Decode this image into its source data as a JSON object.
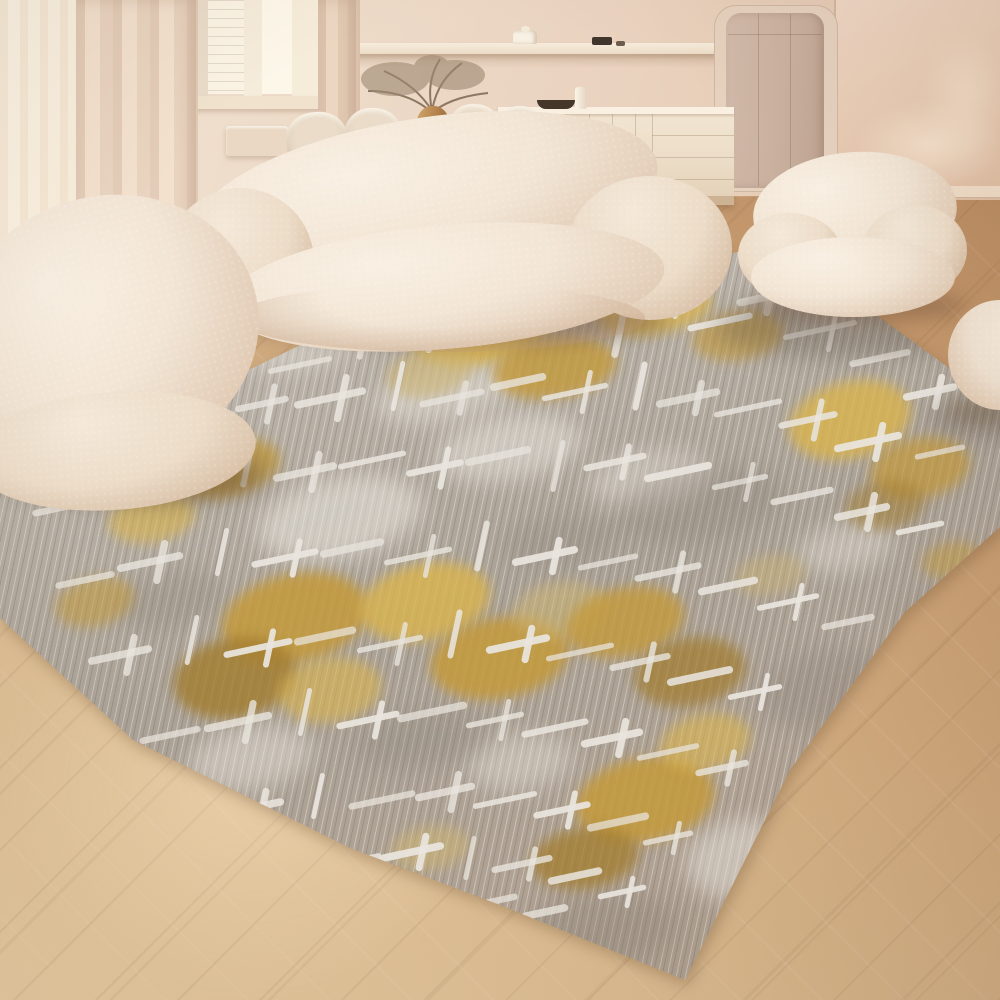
{
  "scene": {
    "label": "living-room-rug-product-photo",
    "objects": [
      "area-rug",
      "curved-boucle-sofa",
      "boucle-lounge-chair",
      "boucle-pouf",
      "boucle-ball-seat",
      "cream-sideboard",
      "wall-shelf",
      "dining-table",
      "dining-chairs",
      "amber-vase-dried-branches",
      "window",
      "sheer-curtains",
      "taupe-door-panel",
      "herringbone-wood-floor",
      "radiator",
      "dark-bowl",
      "white-cylinder-vase",
      "lidded-jar",
      "small-dark-objects"
    ]
  },
  "palette": {
    "wall": "#ecd9c8",
    "wallRight": "#e8cdb8",
    "window": "#fdf4e4",
    "curtain": "#e9d3c0",
    "cream": "#f3e7d9",
    "creamShade": "#d9c0a7",
    "sideboard": "#f0e3d0",
    "door": "#ccb4a3",
    "floorLight": "#e6c89e",
    "floorDark": "#b3845a",
    "rugBase": "#b6afa5",
    "rugLight": "#d8d4cc",
    "rugDark": "#978f84",
    "rugWhite": "#eae6df",
    "gold1": "#dab44e",
    "gold2": "#c49a3a",
    "bronze": "#a37d2e",
    "paleGold": "#cdb472",
    "bowlDark": "#443729",
    "branch": "#97826b",
    "vaseAmber": "#b9854f"
  },
  "rug": {
    "weft_angle_deg": -12,
    "warp_angle_deg": 78,
    "gold_blobs": [
      [
        480,
        330,
        70,
        34,
        -10,
        "gold1",
        0.85
      ],
      [
        555,
        368,
        62,
        30,
        -8,
        "gold2",
        0.8
      ],
      [
        430,
        372,
        44,
        24,
        -12,
        "paleGold",
        0.6
      ],
      [
        655,
        308,
        58,
        26,
        -10,
        "gold1",
        0.75
      ],
      [
        738,
        336,
        46,
        24,
        -8,
        "gold2",
        0.6
      ],
      [
        850,
        420,
        62,
        38,
        -14,
        "gold1",
        0.8
      ],
      [
        920,
        468,
        50,
        30,
        -10,
        "gold2",
        0.7
      ],
      [
        885,
        505,
        40,
        24,
        -8,
        "bronze",
        0.5
      ],
      [
        225,
        468,
        56,
        28,
        -12,
        "gold2",
        0.75
      ],
      [
        152,
        518,
        44,
        24,
        -10,
        "gold1",
        0.6
      ],
      [
        95,
        602,
        40,
        24,
        -14,
        "gold2",
        0.55
      ],
      [
        295,
        618,
        74,
        44,
        -12,
        "gold2",
        0.85
      ],
      [
        235,
        678,
        62,
        40,
        -10,
        "bronze",
        0.8
      ],
      [
        330,
        690,
        52,
        32,
        -8,
        "gold1",
        0.6
      ],
      [
        425,
        602,
        66,
        38,
        -12,
        "gold1",
        0.8
      ],
      [
        500,
        658,
        70,
        40,
        -10,
        "gold2",
        0.85
      ],
      [
        560,
        610,
        48,
        28,
        -8,
        "paleGold",
        0.55
      ],
      [
        625,
        622,
        60,
        34,
        -12,
        "gold2",
        0.8
      ],
      [
        690,
        672,
        56,
        34,
        -10,
        "bronze",
        0.7
      ],
      [
        645,
        800,
        70,
        42,
        -10,
        "gold2",
        0.85
      ],
      [
        585,
        858,
        54,
        30,
        -8,
        "bronze",
        0.75
      ],
      [
        705,
        742,
        46,
        28,
        -12,
        "gold1",
        0.6
      ],
      [
        430,
        848,
        40,
        22,
        -8,
        "paleGold",
        0.55
      ],
      [
        770,
        575,
        36,
        20,
        -10,
        "paleGold",
        0.45
      ],
      [
        952,
        560,
        30,
        18,
        -10,
        "gold2",
        0.5
      ]
    ],
    "sheen_blobs": [
      [
        340,
        518,
        84,
        40,
        -12,
        0.55
      ],
      [
        510,
        448,
        74,
        32,
        -10,
        0.5
      ],
      [
        650,
        478,
        62,
        28,
        -8,
        0.4
      ],
      [
        250,
        758,
        64,
        32,
        -10,
        0.45
      ],
      [
        520,
        762,
        54,
        28,
        -8,
        0.4
      ],
      [
        845,
        548,
        50,
        24,
        -10,
        0.4
      ],
      [
        445,
        392,
        72,
        28,
        -12,
        0.45
      ],
      [
        300,
        345,
        60,
        24,
        -10,
        0.4
      ],
      [
        745,
        860,
        60,
        40,
        -8,
        0.5
      ],
      [
        120,
        440,
        50,
        22,
        -12,
        0.4
      ]
    ],
    "shade_blobs": [
      [
        700,
        505,
        84,
        36,
        -10,
        0.35
      ],
      [
        560,
        540,
        60,
        26,
        -8,
        0.3
      ],
      [
        170,
        600,
        56,
        28,
        -12,
        0.3
      ],
      [
        830,
        690,
        70,
        40,
        -10,
        0.35
      ],
      [
        420,
        740,
        66,
        30,
        -8,
        0.3
      ],
      [
        600,
        930,
        80,
        36,
        -6,
        0.35
      ],
      [
        940,
        620,
        40,
        30,
        -8,
        0.3
      ]
    ],
    "cast_shadows": [
      [
        845,
        328,
        130,
        30,
        0.3
      ],
      [
        470,
        312,
        190,
        26,
        0.22
      ],
      [
        150,
        470,
        120,
        30,
        0.25
      ],
      [
        985,
        420,
        55,
        16,
        0.3
      ]
    ],
    "crosses": [
      [
        300,
        365,
        60,
        0
      ],
      [
        355,
        340,
        46,
        34
      ],
      [
        420,
        330,
        70,
        40
      ],
      [
        500,
        318,
        55,
        0
      ],
      [
        560,
        305,
        60,
        36
      ],
      [
        620,
        330,
        0,
        50
      ],
      [
        668,
        302,
        56,
        30
      ],
      [
        720,
        322,
        60,
        0
      ],
      [
        762,
        298,
        44,
        30
      ],
      [
        820,
        330,
        70,
        40
      ],
      [
        880,
        358,
        56,
        0
      ],
      [
        930,
        392,
        48,
        30
      ],
      [
        205,
        420,
        56,
        0
      ],
      [
        262,
        404,
        48,
        36
      ],
      [
        330,
        398,
        66,
        42
      ],
      [
        398,
        386,
        0,
        46
      ],
      [
        452,
        398,
        60,
        30
      ],
      [
        518,
        382,
        50,
        0
      ],
      [
        575,
        392,
        62,
        40
      ],
      [
        640,
        386,
        0,
        44
      ],
      [
        688,
        398,
        58,
        30
      ],
      [
        748,
        408,
        64,
        0
      ],
      [
        808,
        420,
        54,
        38
      ],
      [
        868,
        442,
        62,
        34
      ],
      [
        940,
        452,
        46,
        0
      ],
      [
        60,
        508,
        50,
        0
      ],
      [
        118,
        486,
        56,
        34
      ],
      [
        188,
        472,
        64,
        0
      ],
      [
        248,
        462,
        0,
        46
      ],
      [
        305,
        472,
        58,
        36
      ],
      [
        372,
        460,
        64,
        0
      ],
      [
        435,
        468,
        52,
        38
      ],
      [
        498,
        456,
        60,
        0
      ],
      [
        558,
        466,
        0,
        48
      ],
      [
        615,
        462,
        58,
        32
      ],
      [
        678,
        472,
        62,
        0
      ],
      [
        740,
        482,
        52,
        36
      ],
      [
        802,
        496,
        58,
        0
      ],
      [
        862,
        512,
        50,
        34
      ],
      [
        920,
        528,
        44,
        0
      ],
      [
        85,
        580,
        54,
        0
      ],
      [
        150,
        562,
        60,
        38
      ],
      [
        222,
        552,
        0,
        44
      ],
      [
        285,
        558,
        62,
        34
      ],
      [
        352,
        548,
        58,
        0
      ],
      [
        418,
        556,
        64,
        40
      ],
      [
        482,
        546,
        0,
        46
      ],
      [
        545,
        556,
        60,
        32
      ],
      [
        608,
        562,
        56,
        0
      ],
      [
        668,
        572,
        62,
        38
      ],
      [
        728,
        586,
        54,
        0
      ],
      [
        788,
        602,
        58,
        34
      ],
      [
        848,
        622,
        48,
        0
      ],
      [
        120,
        655,
        58,
        36
      ],
      [
        192,
        640,
        0,
        46
      ],
      [
        258,
        648,
        64,
        34
      ],
      [
        325,
        636,
        56,
        0
      ],
      [
        390,
        644,
        62,
        40
      ],
      [
        455,
        634,
        0,
        44
      ],
      [
        518,
        644,
        58,
        32
      ],
      [
        580,
        652,
        64,
        0
      ],
      [
        640,
        662,
        56,
        36
      ],
      [
        700,
        676,
        60,
        0
      ],
      [
        755,
        692,
        50,
        34
      ],
      [
        170,
        735,
        56,
        0
      ],
      [
        238,
        722,
        62,
        38
      ],
      [
        305,
        712,
        0,
        44
      ],
      [
        368,
        720,
        58,
        34
      ],
      [
        432,
        712,
        64,
        0
      ],
      [
        495,
        720,
        54,
        38
      ],
      [
        555,
        728,
        62,
        0
      ],
      [
        612,
        738,
        56,
        34
      ],
      [
        668,
        752,
        58,
        0
      ],
      [
        722,
        768,
        48,
        32
      ],
      [
        252,
        808,
        58,
        34
      ],
      [
        318,
        796,
        0,
        42
      ],
      [
        382,
        800,
        62,
        0
      ],
      [
        445,
        792,
        54,
        36
      ],
      [
        505,
        800,
        60,
        0
      ],
      [
        562,
        810,
        52,
        34
      ],
      [
        618,
        822,
        56,
        0
      ],
      [
        668,
        838,
        46,
        30
      ],
      [
        352,
        862,
        54,
        0
      ],
      [
        412,
        852,
        58,
        32
      ],
      [
        470,
        858,
        0,
        40
      ],
      [
        522,
        864,
        56,
        30
      ],
      [
        575,
        876,
        48,
        0
      ],
      [
        622,
        892,
        44,
        28
      ],
      [
        490,
        902,
        50,
        0
      ],
      [
        545,
        912,
        40,
        0
      ]
    ]
  }
}
